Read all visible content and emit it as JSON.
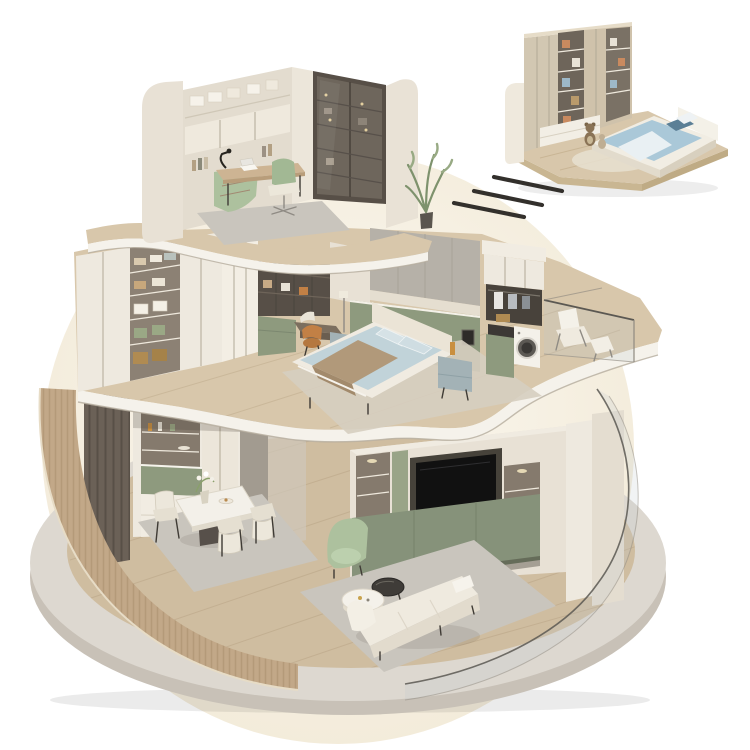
{
  "image": {
    "type": "3d-isometric-cutaway-render",
    "description": "Dollhouse-style cutaway of a three-storey apartment standing on a round stone platform, plus a detached close-up of a kids bedroom in the top-right corner linked by three motion dashes. No text appears in the image."
  },
  "colors": {
    "background": "#ffffff",
    "backdrop": "#f7f1e3",
    "platform_top": "#ddd8d0",
    "platform_side": "#c8c1b7",
    "wood_floor": "#cfbda0",
    "plank_line": "#b7a283",
    "wood_slab": "#d8c7ab",
    "fascia": "#f5f2eb",
    "fluted_wood": "#c2a888",
    "flute_stripe": "#a98d6c",
    "cream_wall": "#e8e1d5",
    "cream_dark": "#d9d1c2",
    "cabinet_white": "#eee9df",
    "white_soft": "#f1ece2",
    "shelf_interior": "#857a6d",
    "dark_wood": "#6b6157",
    "bronze_frame": "#574f47",
    "olive": "#8e9a7e",
    "olive_dark": "#86927a",
    "sage": "#adc19e",
    "grey_panel": "#b6b1a8",
    "rug_grey": "#c9c5bd",
    "rug_beige": "#d6cec0",
    "tv_black": "#111111",
    "bedding_blue": "#c1d3d9",
    "duvet_blue": "#aac8d8",
    "throw_tan": "#b1997a",
    "steel_blue": "#a3b2b6",
    "orange_leather": "#c28045",
    "wicker": "#b08b52",
    "glass_edge": "#5b5852",
    "stroke_dark": "#33302c"
  },
  "scene": {
    "base": {
      "name": "circular-stone-platform",
      "items": [
        "stone-rim",
        "plank-wood-floor",
        "fluted-curved-wall"
      ]
    },
    "ground_floor": {
      "name": "living-dining",
      "items": [
        "wood-slat-partition",
        "display-cabinet",
        "dining-table",
        "dining-chairs",
        "flower-vase",
        "tv-wall-unit",
        "television",
        "media-shelves",
        "sage-recliner",
        "white-sofa",
        "coffee-tables",
        "area-rug",
        "curved-glass-railing"
      ]
    },
    "middle_floor": {
      "name": "bedroom-suite",
      "items": [
        "walk-in-wardrobe",
        "dressing-shelves",
        "vanity-chair",
        "double-bed",
        "nightstands",
        "upholstered-wall",
        "laundry-tower",
        "washing-machine",
        "balcony-glass-railing",
        "lounge-chair"
      ]
    },
    "top_floor": {
      "name": "study",
      "items": [
        "curved-side-walls",
        "wall-shelving",
        "glass-door-bookcase",
        "writing-desk",
        "desk-lamp",
        "laptop",
        "task-chair",
        "sage-sofa",
        "area-rug",
        "potted-plant"
      ]
    },
    "inset_room": {
      "name": "kids-bedroom-closeup",
      "items": [
        "toy-wardrobe",
        "platform-bed-blue-bedding",
        "teddy-bears",
        "round-rug",
        "wood-base"
      ]
    },
    "link_strokes": {
      "count": 3
    }
  }
}
